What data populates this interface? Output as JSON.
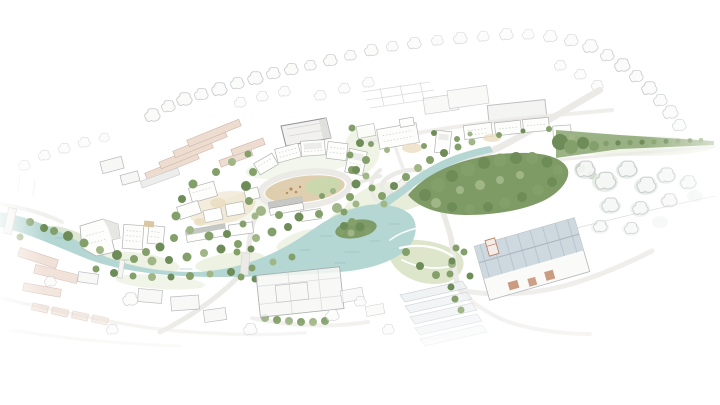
{
  "scene": {
    "alt": "Hand-drawn watercolour and pencil aerial masterplan illustration of a riverside town: a pale teal river meanders from the left, widens into a basin with a small wooded island, and continues as a narrow channel to the north-east; white apartment blocks ring an oval plaza at the centre, dense green woodland and riverside trees line the banks, a tree-lined green avenue recedes toward the right horizon, a large blue-grey industrial shed and warehouses sit to the south-east, and the surrounding streets, terraces and trees fade out into faint pencil sketch and white paper at the edges.",
    "style": "watercolour-and-pencil architectural masterplan sketch",
    "features": [
      "river",
      "river-basin",
      "river-channel",
      "island",
      "woodland",
      "riverside-trees",
      "oval-plaza",
      "oval-ring-road",
      "central-housing-cluster",
      "crescent-buildings",
      "riverside-apartment-blocks",
      "north-building-row",
      "tree-lined-avenue",
      "industrial-shed",
      "warehouse-district",
      "road-junction",
      "causeway-road",
      "footbridge",
      "west-bridge",
      "terraced-housing-sketch",
      "courtyard-building-sketch",
      "pencil-context-town",
      "grass-washes",
      "paper-fade"
    ],
    "palette": {
      "paper": "#ffffff",
      "pencil": "#bcc1c3",
      "pencilDark": "#8f9496",
      "river": "#b5d7d3",
      "ripple": "#8ebcb6",
      "grass": "#cfdcb4",
      "grassL": "#e1e9cf",
      "treeD": "#6d8c57",
      "tree": "#84a06a",
      "treeL": "#a0b687",
      "sand": "#d9c7a2",
      "sandL": "#e9dcbd",
      "wall": "#fdfdfb",
      "wallEdge": "#b0b4b2",
      "roofG": "#c5c8c4",
      "roofD": "#9aa09b",
      "terracotta": "#ecd9cc",
      "terracottaEdge": "#c9ab9c",
      "shedRoof": "#cdd8df",
      "shedStripe": "#b8c6d0",
      "rust": "#c18a6a",
      "road": "#ebeae6",
      "roadEdge": "#d4d4d1",
      "wash": "#dfe7e3"
    }
  }
}
